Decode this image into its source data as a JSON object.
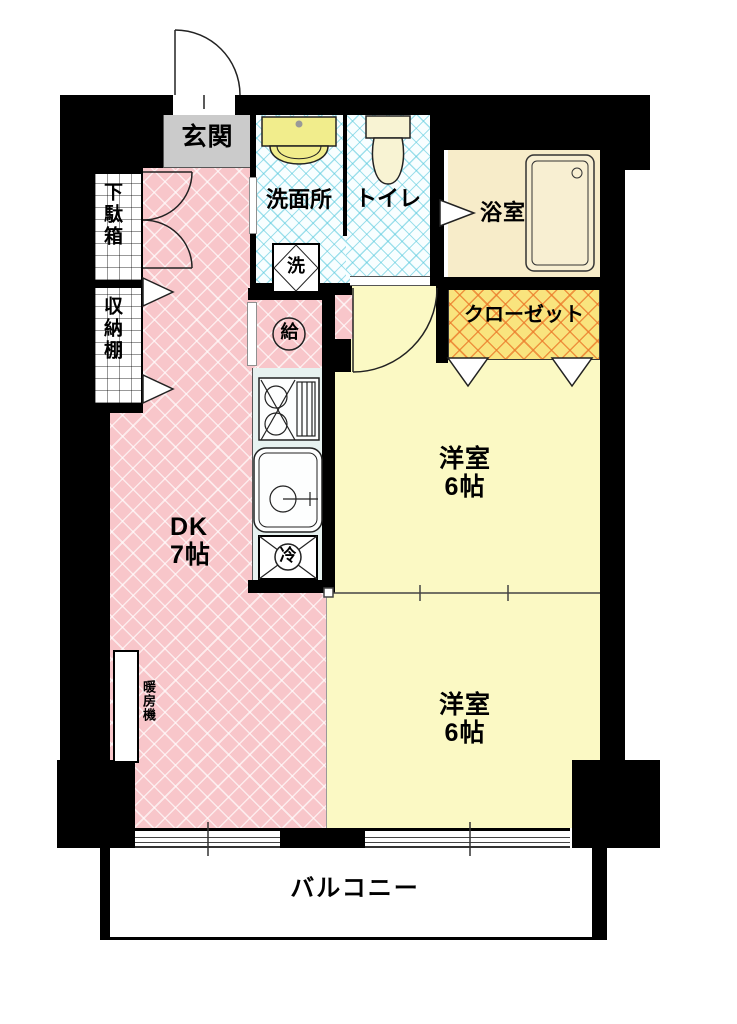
{
  "plan": {
    "entrance": {
      "label": "玄関"
    },
    "pipe_space": {
      "label": "PS"
    },
    "shoe_cabinet": {
      "label": "下駄箱"
    },
    "storage_shelf": {
      "label": "収納棚"
    },
    "washroom": {
      "label": "洗面所"
    },
    "washer": {
      "label": "洗"
    },
    "water_heater": {
      "label": "給"
    },
    "toilet": {
      "label": "トイレ"
    },
    "bathroom": {
      "label": "浴室"
    },
    "closet": {
      "label": "クローゼット"
    },
    "dining_kitchen": {
      "label": "DK",
      "size": "7帖"
    },
    "bedroom_upper": {
      "label": "洋室",
      "size": "6帖"
    },
    "bedroom_lower": {
      "label": "洋室",
      "size": "6帖"
    },
    "refrigerator": {
      "label": "冷"
    },
    "heater": {
      "label": "暖房機"
    },
    "balcony": {
      "label": "バルコニー"
    }
  },
  "colors": {
    "wall": "#000000",
    "dk_floor": "#F8C6CA",
    "bedroom_floor": "#FBF9C4",
    "wet_area_base": "#F8FEFF",
    "wet_area_hatch": "#55C8DC",
    "closet_fill": "#F9E47E",
    "closet_hatch": "#EB7828",
    "bath_fill": "#F7ECC9",
    "gray_box": "#CBCBCB",
    "basin_fixture": "#F1ED8C",
    "toilet_fixture": "#F8F3D3"
  }
}
